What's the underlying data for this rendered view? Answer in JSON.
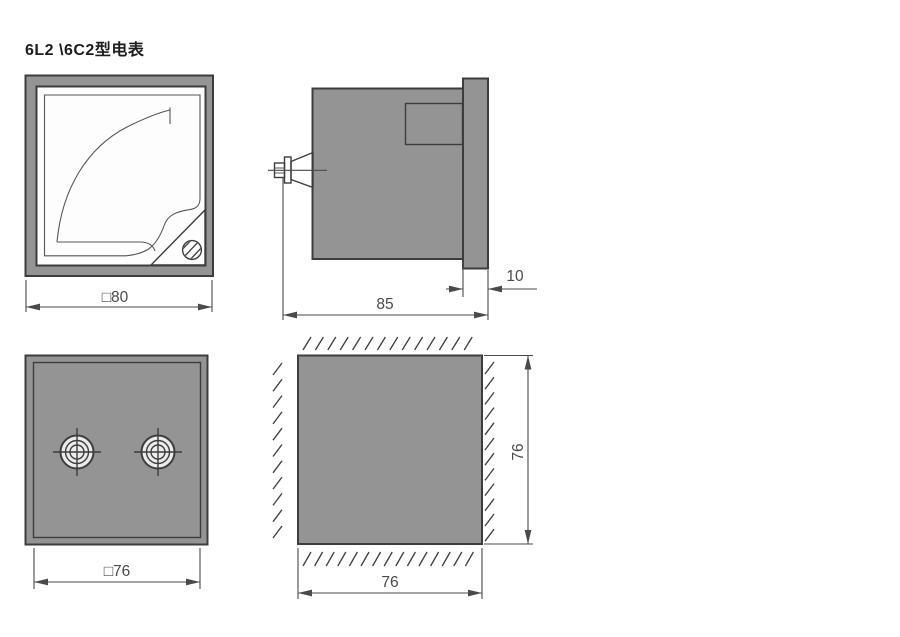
{
  "title": "6L2 \\6C2型电表",
  "colors": {
    "body_gray": "#949494",
    "terminal_gray": "#d9d9d9",
    "face_white": "#fdfdfd",
    "screw_face": "#ececec",
    "outline": "#3d3d3d",
    "dimension": "#4a4a4a"
  },
  "dimensions": {
    "front_width": "□80",
    "side_depth": "85",
    "side_flange": "10",
    "rear_width": "□76",
    "cutout_width": "76",
    "cutout_height": "76"
  }
}
